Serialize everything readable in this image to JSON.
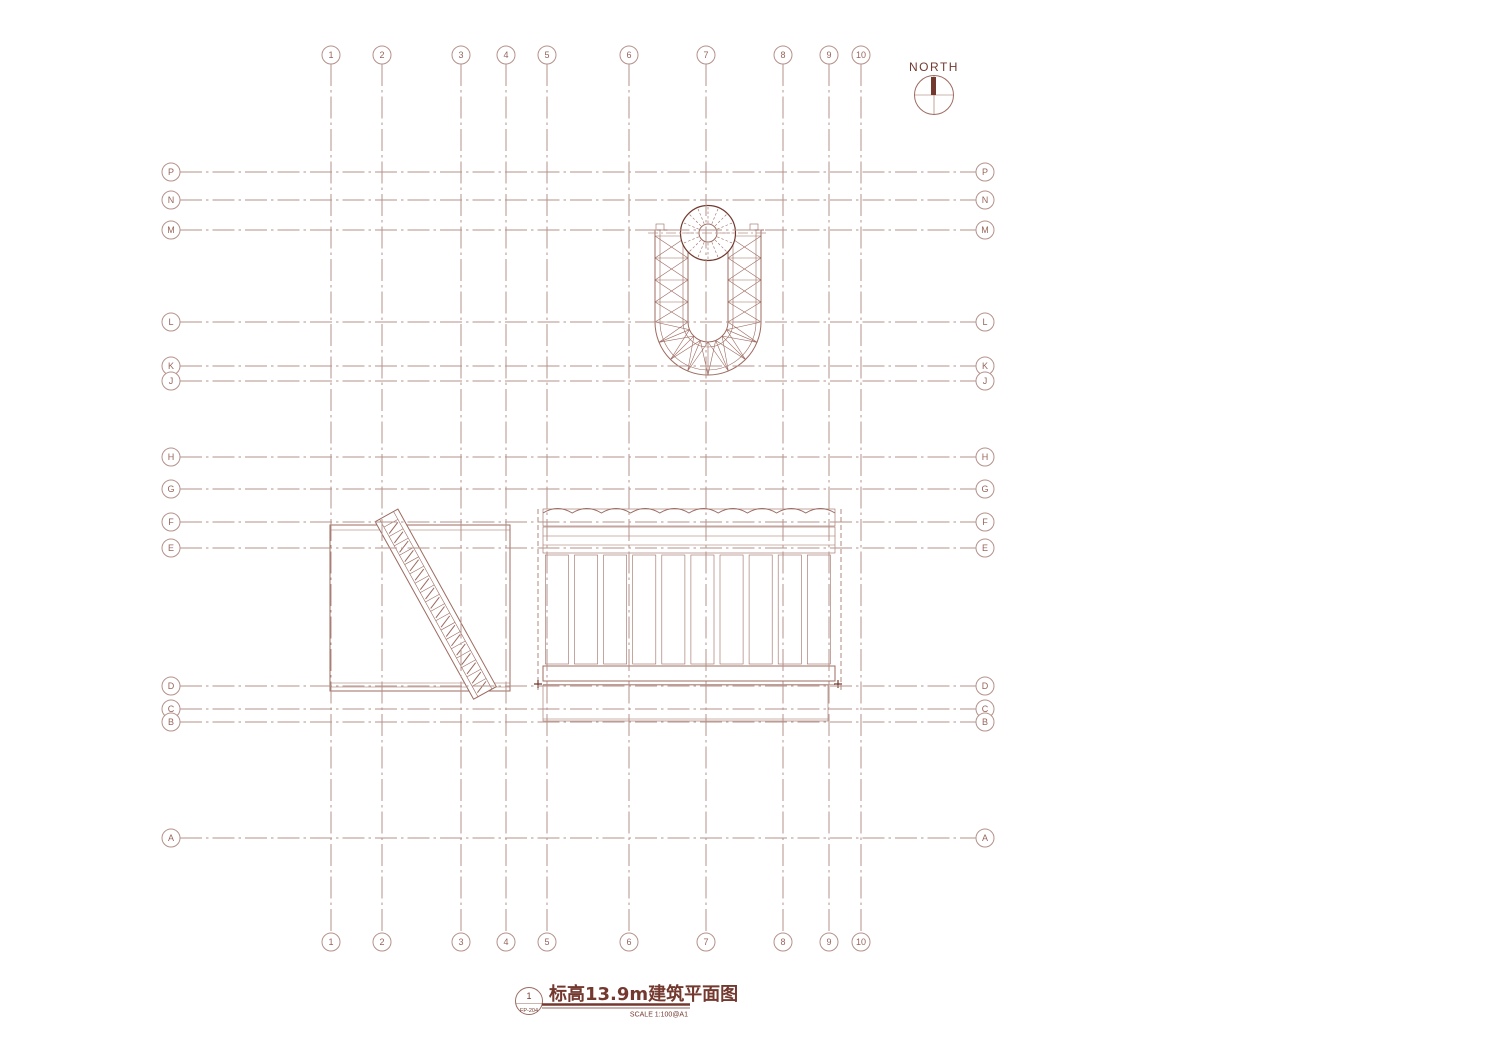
{
  "sheet": {
    "north_label": "NORTH",
    "title": "标高13.9m建筑平面图",
    "scale_note": "SCALE 1:100@A1",
    "detail_ref": {
      "number": "1",
      "sheet": "FP-204"
    }
  },
  "colors": {
    "line": "#9c6b60",
    "grid": "#b5918a",
    "dark": "#73392f",
    "hatch": "#a97e73",
    "fill_light": "#dcc3bb"
  },
  "grid": {
    "columns": [
      {
        "label": "1",
        "x": 331
      },
      {
        "label": "2",
        "x": 382
      },
      {
        "label": "3",
        "x": 461
      },
      {
        "label": "4",
        "x": 506
      },
      {
        "label": "5",
        "x": 547
      },
      {
        "label": "6",
        "x": 629
      },
      {
        "label": "7",
        "x": 706
      },
      {
        "label": "8",
        "x": 783
      },
      {
        "label": "9",
        "x": 829
      },
      {
        "label": "10",
        "x": 861
      }
    ],
    "rows": [
      {
        "label": "P",
        "y": 172
      },
      {
        "label": "N",
        "y": 200
      },
      {
        "label": "M",
        "y": 230
      },
      {
        "label": "L",
        "y": 322
      },
      {
        "label": "K",
        "y": 366
      },
      {
        "label": "J",
        "y": 381
      },
      {
        "label": "H",
        "y": 457
      },
      {
        "label": "G",
        "y": 489
      },
      {
        "label": "F",
        "y": 522
      },
      {
        "label": "E",
        "y": 548
      },
      {
        "label": "D",
        "y": 686
      },
      {
        "label": "C",
        "y": 709
      },
      {
        "label": "B",
        "y": 722
      },
      {
        "label": "A",
        "y": 838
      }
    ],
    "bubble_top_y": 55,
    "bubble_bottom_y": 942,
    "bubble_left_x": 171,
    "bubble_right_x": 985,
    "vline_y1": 64,
    "vline_y2": 933,
    "hline_x1": 180,
    "hline_x2": 976
  }
}
